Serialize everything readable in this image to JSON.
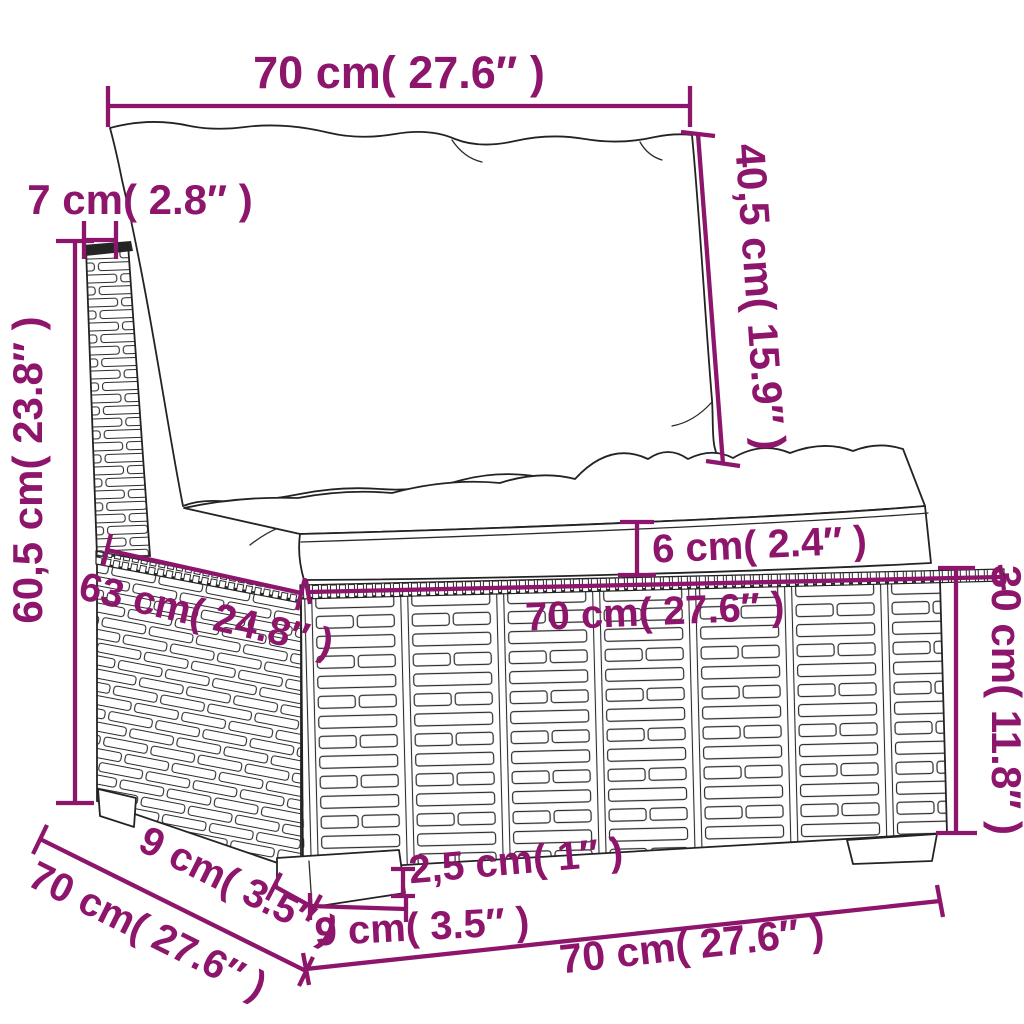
{
  "title": "Sectional sofa middle seat with cushions — dimension diagram",
  "colors": {
    "accent": "#8D156B",
    "outline": "#232323",
    "background": "#FFFFFF"
  },
  "labels": {
    "back_width": "70 cm( 27.6″ )",
    "back_thickness": "7 cm( 2.8″ )",
    "total_height": "60,5 cm( 23.8″ )",
    "back_cushion_height": "40,5 cm( 15.9″ )",
    "cushion_thickness": "6 cm( 2.4″ )",
    "seat_width": "70 cm( 27.6″ )",
    "seat_depth": "63 cm( 24.8″ )",
    "base_height": "30 cm( 11.8″ )",
    "total_depth": "70 cm( 27.6″ )",
    "leg_depth": "9 cm( 3.5″ )",
    "leg_height": "2,5 cm( 1″ )",
    "leg_width": "9 cm( 3.5″ )",
    "bottom_width": "70 cm( 27.6″ )"
  },
  "measurements": [
    {
      "part": "back-cushion-width",
      "cm": 70,
      "inches": 27.6
    },
    {
      "part": "backrest-thickness",
      "cm": 7,
      "inches": 2.8
    },
    {
      "part": "total-height",
      "cm": 60.5,
      "inches": 23.8
    },
    {
      "part": "back-cushion-height",
      "cm": 40.5,
      "inches": 15.9
    },
    {
      "part": "seat-cushion-thickness",
      "cm": 6,
      "inches": 2.4
    },
    {
      "part": "seat-width",
      "cm": 70,
      "inches": 27.6
    },
    {
      "part": "seat-depth",
      "cm": 63,
      "inches": 24.8
    },
    {
      "part": "base-height",
      "cm": 30,
      "inches": 11.8
    },
    {
      "part": "total-depth",
      "cm": 70,
      "inches": 27.6
    },
    {
      "part": "leg-depth",
      "cm": 9,
      "inches": 3.5
    },
    {
      "part": "leg-height",
      "cm": 2.5,
      "inches": 1
    },
    {
      "part": "leg-width",
      "cm": 9,
      "inches": 3.5
    },
    {
      "part": "bottom-width",
      "cm": 70,
      "inches": 27.6
    }
  ]
}
